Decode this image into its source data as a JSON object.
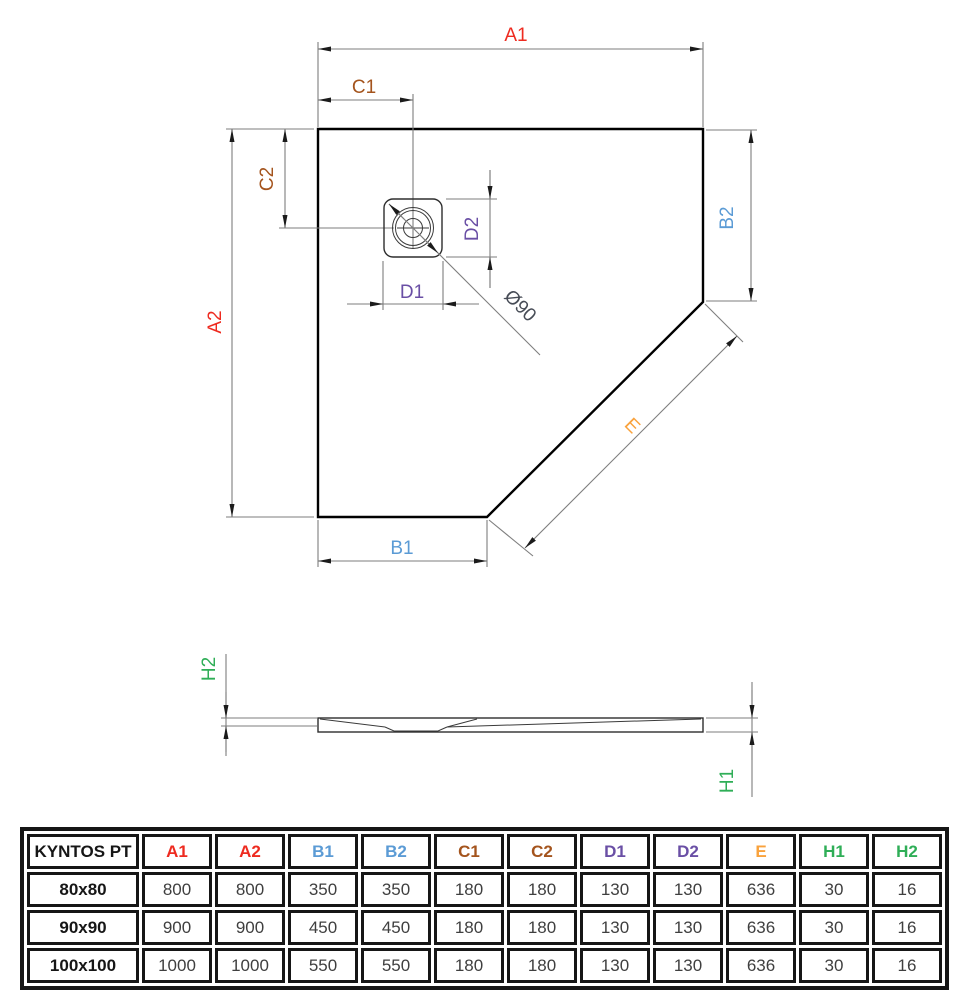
{
  "product": "KYNTOS PT",
  "drawing": {
    "labels": {
      "a1": {
        "text": "A1",
        "color": "#ee2b20"
      },
      "a2": {
        "text": "A2",
        "color": "#ee2b20"
      },
      "b1": {
        "text": "B1",
        "color": "#5b9bd5"
      },
      "b2": {
        "text": "B2",
        "color": "#5b9bd5"
      },
      "c1": {
        "text": "C1",
        "color": "#a4541d"
      },
      "c2": {
        "text": "C2",
        "color": "#a4541d"
      },
      "d1": {
        "text": "D1",
        "color": "#6a4fa5"
      },
      "d2": {
        "text": "D2",
        "color": "#6a4fa5"
      },
      "e": {
        "text": "E",
        "color": "#f9a23c"
      },
      "h1": {
        "text": "H1",
        "color": "#2fae57"
      },
      "h2": {
        "text": "H2",
        "color": "#2fae57"
      },
      "diameter": {
        "text": "Ø90",
        "color": "#474c56"
      }
    }
  },
  "table": {
    "header": [
      {
        "text": "KYNTOS PT",
        "color": "#161616"
      },
      {
        "text": "A1",
        "color": "#ee2b20"
      },
      {
        "text": "A2",
        "color": "#ee2b20"
      },
      {
        "text": "B1",
        "color": "#5b9bd5"
      },
      {
        "text": "B2",
        "color": "#5b9bd5"
      },
      {
        "text": "C1",
        "color": "#a4541d"
      },
      {
        "text": "C2",
        "color": "#a4541d"
      },
      {
        "text": "D1",
        "color": "#6a4fa5"
      },
      {
        "text": "D2",
        "color": "#6a4fa5"
      },
      {
        "text": "E",
        "color": "#f9a23c"
      },
      {
        "text": "H1",
        "color": "#2fae57"
      },
      {
        "text": "H2",
        "color": "#2fae57"
      }
    ],
    "rows": [
      {
        "model": "80x80",
        "values": [
          "800",
          "800",
          "350",
          "350",
          "180",
          "180",
          "130",
          "130",
          "636",
          "30",
          "16"
        ]
      },
      {
        "model": "90x90",
        "values": [
          "900",
          "900",
          "450",
          "450",
          "180",
          "180",
          "130",
          "130",
          "636",
          "30",
          "16"
        ]
      },
      {
        "model": "100x100",
        "values": [
          "1000",
          "1000",
          "550",
          "550",
          "180",
          "180",
          "130",
          "130",
          "636",
          "30",
          "16"
        ]
      }
    ]
  }
}
